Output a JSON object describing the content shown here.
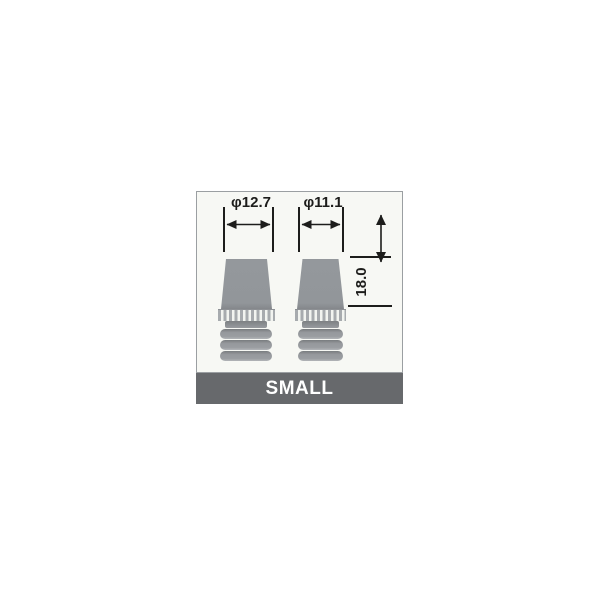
{
  "canvas": {
    "background": "#ffffff"
  },
  "diagram": {
    "panel_background": "#f7f8f4",
    "panel_border_color": "#9b9fa2",
    "line_color": "#1d1d1b",
    "part_fill_color": "#94989c",
    "dimensions": {
      "left_diameter_label": "φ12.7",
      "left_diameter_value": 12.7,
      "right_diameter_label": "φ11.1",
      "right_diameter_value": 11.1,
      "height_label": "18.0",
      "height_value": 18.0
    },
    "parts": [
      {
        "id": "left-plug",
        "description_label": "φ12.7"
      },
      {
        "id": "right-plug",
        "description_label": "φ11.1"
      }
    ]
  },
  "banner": {
    "label": "SMALL",
    "background": "#67696c",
    "text_color": "#ffffff"
  }
}
